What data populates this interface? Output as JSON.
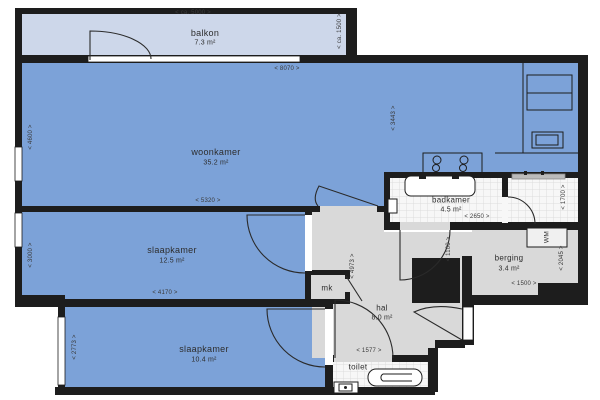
{
  "rooms": {
    "balkon": {
      "name": "balkon",
      "area": "7.3 m²"
    },
    "woonkamer": {
      "name": "woonkamer",
      "area": "35.2 m²"
    },
    "slaapkamer1": {
      "name": "slaapkamer",
      "area": "12.5 m²"
    },
    "slaapkamer2": {
      "name": "slaapkamer",
      "area": "10.4 m²"
    },
    "badkamer": {
      "name": "badkamer",
      "area": "4.5 m²"
    },
    "berging": {
      "name": "berging",
      "area": "3.4 m²"
    },
    "hal": {
      "name": "hal",
      "area": "8.0 m²"
    },
    "toilet": {
      "name": "toilet"
    },
    "mk": {
      "name": "mk"
    },
    "wm": {
      "name": "WM"
    }
  },
  "dimensions": {
    "balkon_width": "< ca. 5000 >",
    "balkon_depth": "< ca. 1500 >",
    "woonkamer_top": "< 8070 >",
    "woonkamer_left": "< 4600 >",
    "woonkamer_right": "< 3443 >",
    "woonkamer_bottom": "< 5320 >",
    "slaapkamer1_left": "< 3000 >",
    "slaapkamer1_bottom": "< 4170 >",
    "slaapkamer2_left": "< 2773 >",
    "badkamer_bottom": "< 2650 >",
    "hal_passage": "< 1100 >",
    "douche_right": "< 1700 >",
    "berging_bottom": "< 1500 >",
    "berging_right": "< 2045 >",
    "hal_bottom": "< 1577 >",
    "hal_left": "< 4973 >"
  },
  "colors": {
    "room_fill": "#7ca2d8",
    "balcony_fill": "#cdd7ea",
    "hall_fill": "#d9d9d9",
    "wall": "#1d1d1d",
    "tile_fill": "#f7f7f7",
    "tile_line": "#dcdcdc",
    "line": "#2a2a2a"
  }
}
